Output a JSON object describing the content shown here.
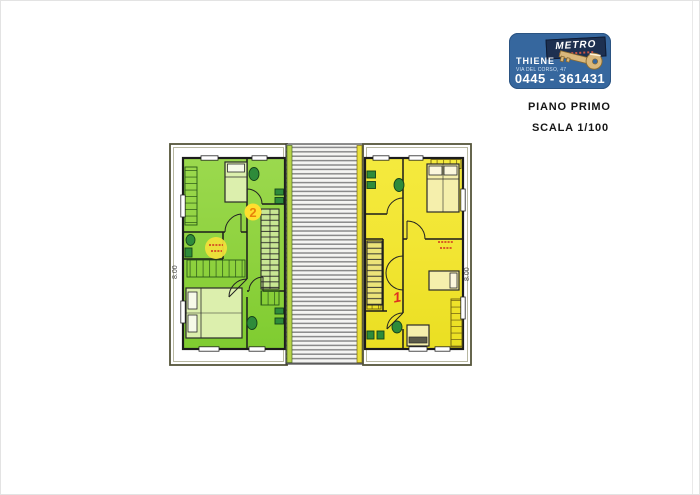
{
  "page": {
    "floor_label": "PIANO PRIMO",
    "scale_label": "SCALA 1/100"
  },
  "logo": {
    "brand": "METRO",
    "city": "THIENE",
    "address": "VIA DEL CORSO, 47",
    "phone": "0445 - 361431",
    "bg_color": "#36679E",
    "plate_color": "#1D3050",
    "key_color": "#D9B87C"
  },
  "plan": {
    "unit_left": {
      "number": "2",
      "fill": "#8FD23F",
      "badge_fill": "#FFDF2E",
      "number_color": "#E8820A"
    },
    "unit_right": {
      "number": "1",
      "fill": "#F2E532",
      "number_color": "#E03020"
    },
    "dimension_left": "8.00",
    "dimension_right": "8.00",
    "roof_hatch_color": "#8A8A8A",
    "fixture_color": "#2E8B3A"
  }
}
